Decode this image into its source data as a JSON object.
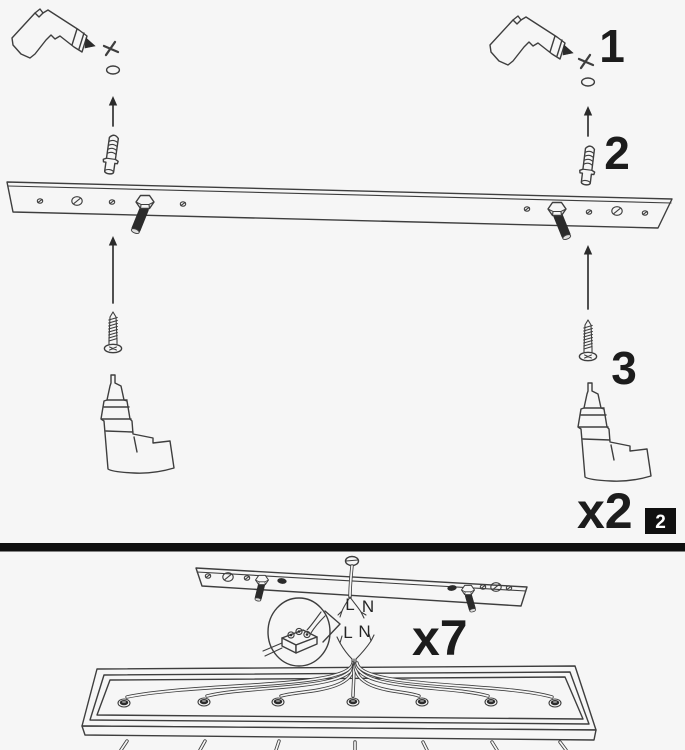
{
  "colors": {
    "background": "#f6f6f6",
    "ink": "#3e3e3e",
    "dark_fill": "#2b2b2b",
    "divider": "#101010",
    "badge_bg": "#101010",
    "badge_text": "#ffffff"
  },
  "top_panel": {
    "step_1_label": "1",
    "step_2_label": "2",
    "step_3_label": "3",
    "quantity_label": "x2",
    "page_number": "2"
  },
  "bottom_panel": {
    "quantity_label": "x7",
    "mains_wire_live": "L",
    "mains_wire_neutral": "N",
    "fixture_wire_live": "L",
    "fixture_wire_neutral": "N"
  }
}
